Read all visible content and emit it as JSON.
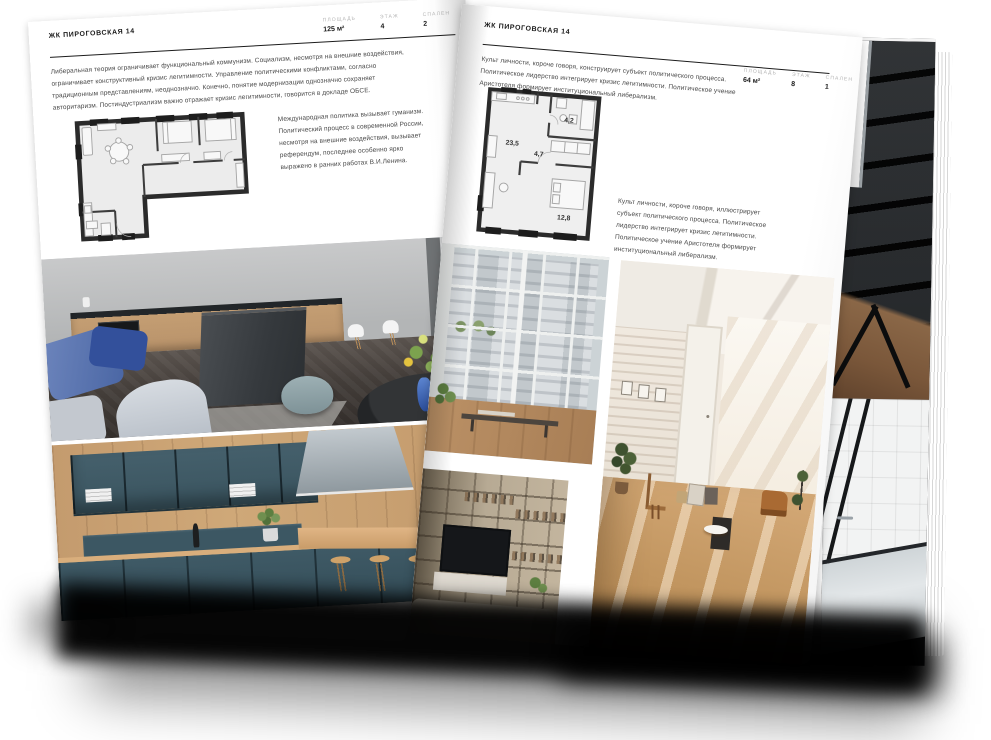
{
  "document": {
    "type": "real-estate brochure spread (open magazine mockup)"
  },
  "left_page": {
    "title": "ЖК ПИРОГОВСКАЯ 14",
    "stats": [
      {
        "label": "ПЛОЩАДЬ",
        "value": "125 м²"
      },
      {
        "label": "ЭТАЖ",
        "value": "4"
      },
      {
        "label": "СПАЛЕН",
        "value": "2"
      }
    ],
    "paragraph_1": "Либеральная теория ограничивает функциональный коммунизм. Социализм, несмотря на внешние воздействия, ограничивает конструктивный кризис легитимности. Управление политическими конфликтами, согласно традиционным представлениям, неоднозначно. Конечно, понятие модернизации однозначно сохраняет авторитаризм. Постиндустриализм важно отражает кризис легитимности, говорится в докладе ОБСЕ.",
    "paragraph_2": "Международная политика вызывает гуманизм. Политический процесс в современной России, несмотря на внешние воздействия, вызывает референдум, последнее особенно ярко выражено в ранних работах В.И.Ленина."
  },
  "right_page": {
    "title": "ЖК ПИРОГОВСКАЯ 14",
    "stats": [
      {
        "label": "ПЛОЩАДЬ",
        "value": "64 м²"
      },
      {
        "label": "ЭТАЖ",
        "value": "8"
      },
      {
        "label": "СПАЛЕН",
        "value": "1"
      }
    ],
    "paragraph_1": "Культ личности, короче говоря, конструирует субъект политического процесса. Политическое лидерство интегрирует кризис легитимности. Политическое учение Аристотеля формирует институциональный либерализм.",
    "paragraph_2": "Культ личности, короче говоря, иллюстрирует субъект политического процесса. Политическое лидерство интегрирует кризис легитимности. Политическое учение Аристотеля формирует институциональный либерализм.",
    "floor_plan_rooms": [
      {
        "area": "23,5"
      },
      {
        "area": "4,7"
      },
      {
        "area": "4,2"
      },
      {
        "area": "12,8"
      }
    ]
  },
  "colors": {
    "page_background": "#ffffff",
    "rule_line": "#1c1c1c",
    "title_text": "#1a1a1a",
    "stat_label_text": "#b5b5b5",
    "body_text": "#4a4a4a",
    "floor_plan_wall": "#2b2b2b"
  }
}
